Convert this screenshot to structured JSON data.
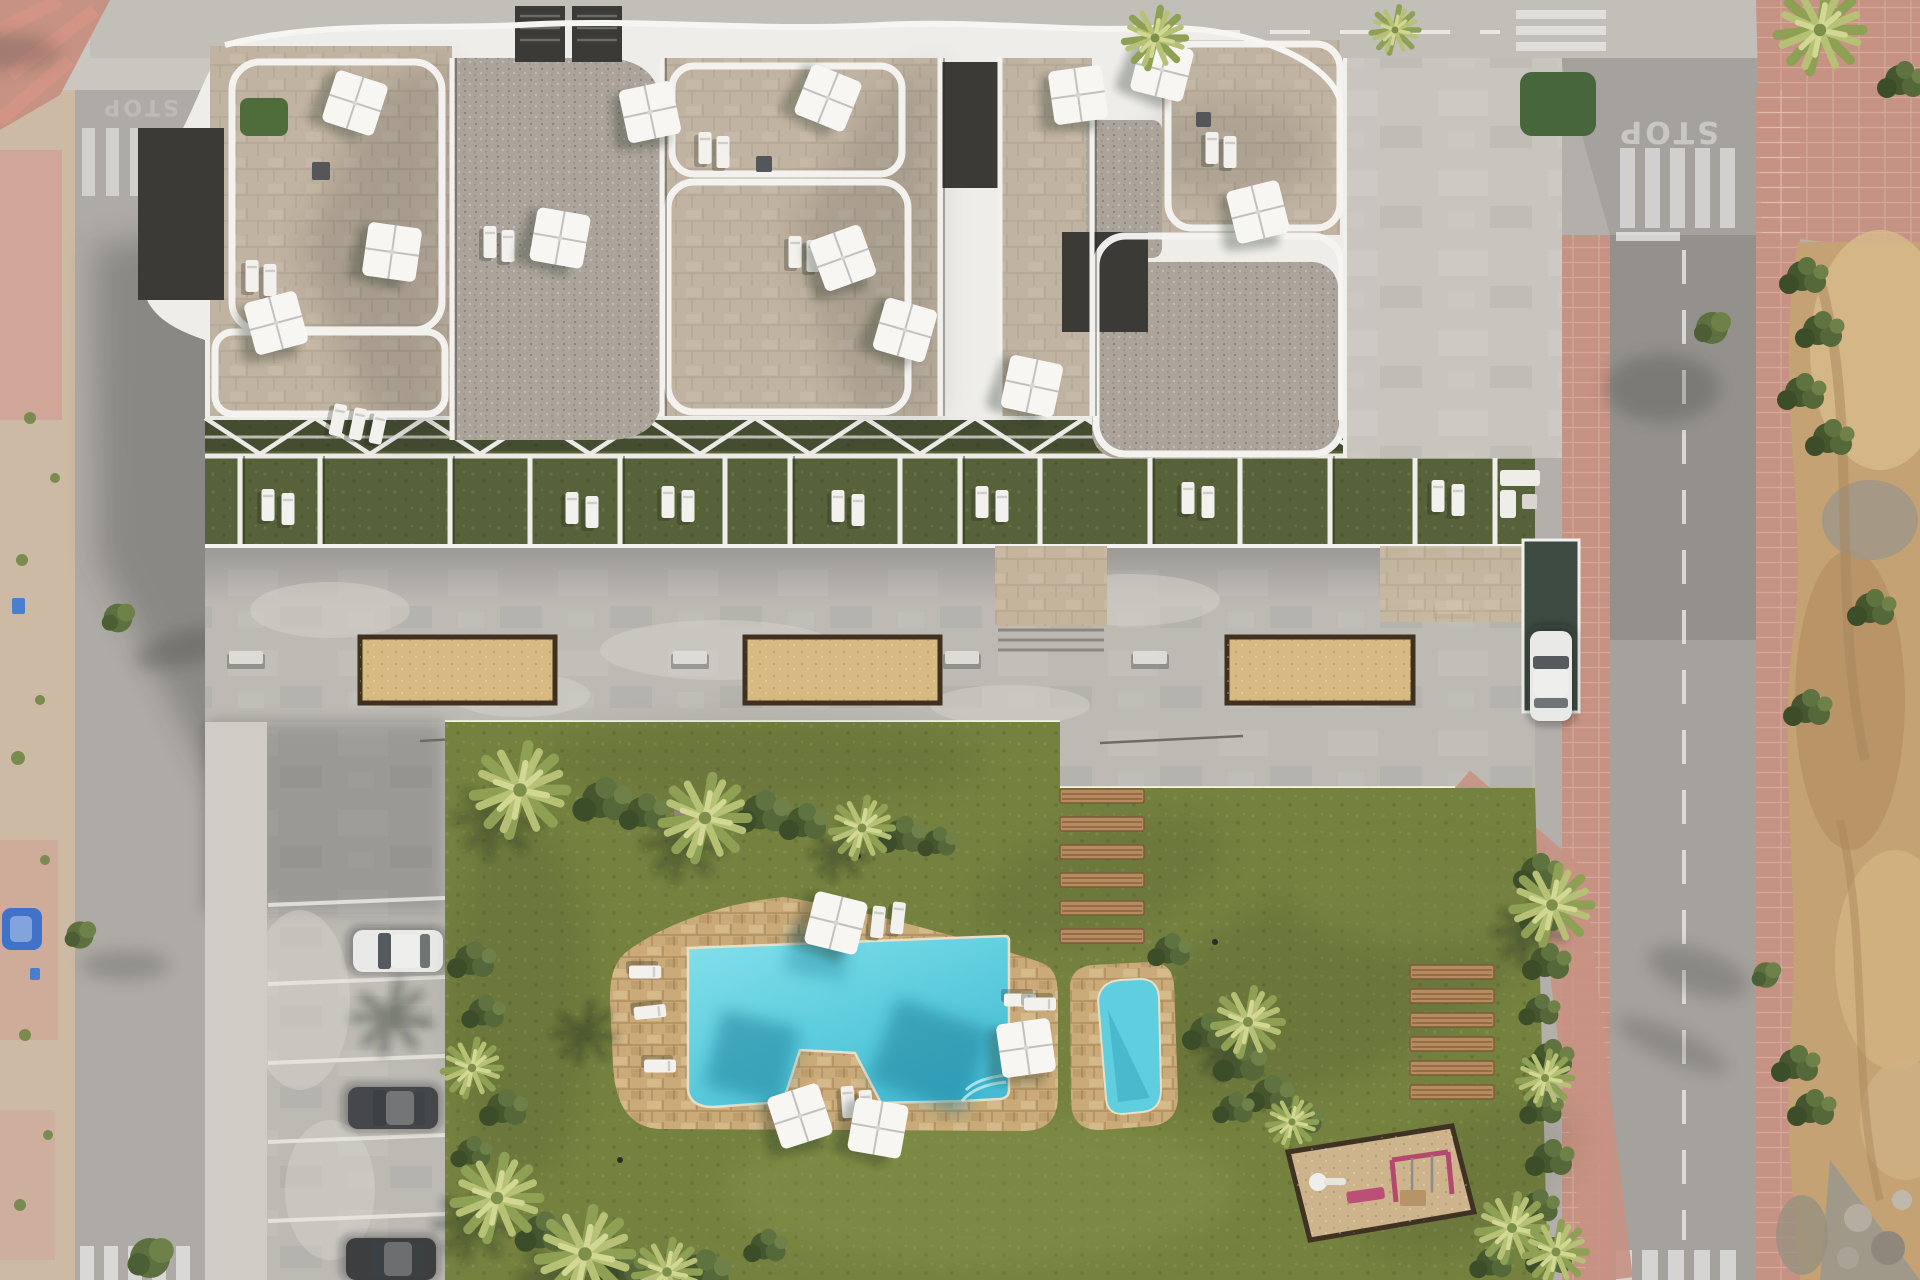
{
  "scene": {
    "description": "aerial drone view of a modern apartment complex with roof terraces, communal deck, lawn garden, free-form swimming pool, kids pool, parking and surrounding streets"
  },
  "road_markings": {
    "stop": "STOP"
  },
  "colors": {
    "asphalt": "#b3afaa",
    "asphalt_light": "#cac6c0",
    "asphalt_dark": "#94918d",
    "sidewalk_sand": "#cdbaa5",
    "sidewalk_pink": "#c69283",
    "dirt": "#c4a273",
    "dirt_light": "#d8bb8c",
    "dirt_dark": "#a8865c",
    "rubble": "#a09889",
    "concrete": "#bdbab4",
    "concrete_light": "#d0cdc7",
    "building": "#efedea",
    "terrace_stone": "#c1b3a1",
    "gravel": "#aca49a",
    "charcoal": "#3b3a37",
    "patio_green": "#57623a",
    "lawn": "#74813f",
    "lawn_light": "#8b9a4e",
    "lawn_dark": "#5a682f",
    "pool_deck": "#c9aa78",
    "water": "#5fcede",
    "water_deep": "#2f9fb9",
    "sand_planter": "#d7ba81",
    "playground_sand": "#cdb48d",
    "wood": "#b08257",
    "wood_dark": "#7c5a3c",
    "white": "#f6f5f2",
    "car_white": "#e9e9e7",
    "car_dark": "#45474a",
    "car_blue": "#3f72c8",
    "equipment_pink": "#bb4f78",
    "foliage": "#55683a",
    "foliage_dark": "#3c4d29",
    "palm": "#b7c176"
  },
  "inventory": {
    "roof_umbrellas": 12,
    "pool_umbrellas": 4,
    "sand_planters": 3,
    "wooden_garden_benches": 6,
    "wooden_steps": 7,
    "parked_cars_left": 3,
    "driveway_car": 1,
    "small_blue_car": 1,
    "pools": 2,
    "playground": 1
  }
}
